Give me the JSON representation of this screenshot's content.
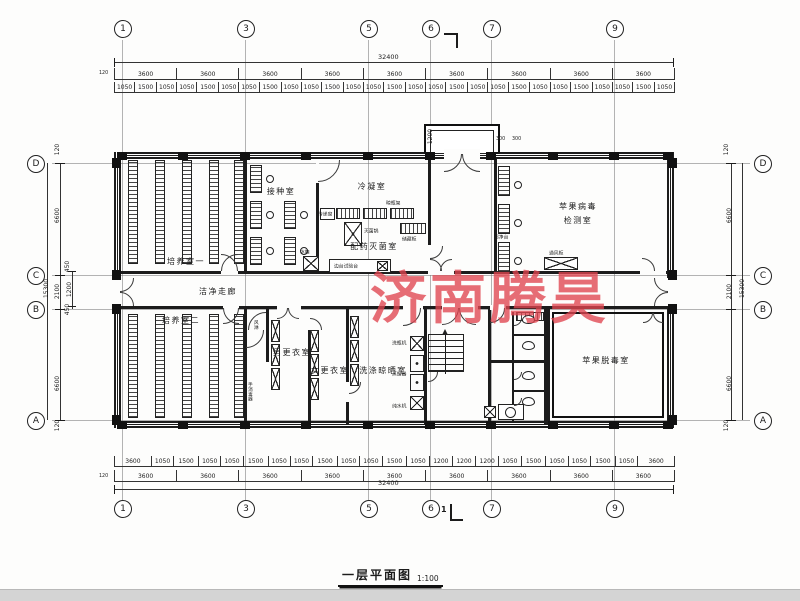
{
  "watermark": "济南腾昊",
  "title": {
    "text": "一层平面图",
    "scale": "1:100"
  },
  "section_mark": "1",
  "grid": {
    "top": [
      "1",
      "3",
      "5",
      "6",
      "7",
      "9"
    ],
    "bottom": [
      "1",
      "3",
      "5",
      "6",
      "7",
      "9"
    ],
    "left": [
      "D",
      "C",
      "B",
      "A"
    ],
    "right": [
      "D",
      "C",
      "B",
      "A"
    ]
  },
  "dims": {
    "top_overall": "32400",
    "top_offset": "120",
    "top_bays": [
      "3600",
      "3600",
      "3600",
      "3600",
      "3600",
      "3600",
      "3600",
      "3600",
      "3600"
    ],
    "top_detail": [
      "1050",
      "1500",
      "1050",
      "1050",
      "1500",
      "1050",
      "1050",
      "1500",
      "1050",
      "1050",
      "1500",
      "1050",
      "1050",
      "1500",
      "1050",
      "1050",
      "1500",
      "1050",
      "1050",
      "1500",
      "1050",
      "1050",
      "1500",
      "1050",
      "1050",
      "1500",
      "1050"
    ],
    "bottom_detail": [
      "3600",
      "1050",
      "1500",
      "1050",
      "1050",
      "1500",
      "1050",
      "1050",
      "1500",
      "1050",
      "1050",
      "1500",
      "1050",
      "1200",
      "1200",
      "1200",
      "1050",
      "1500",
      "1050",
      "1050",
      "1500",
      "1050",
      "3600"
    ],
    "bottom_bays": [
      "3600",
      "3600",
      "3600",
      "3600",
      "3600",
      "3600",
      "3600",
      "3600",
      "3600"
    ],
    "bottom_overall": "32400",
    "bottom_offset": "120",
    "left": {
      "offset_top": "120",
      "d_c": "6600",
      "sub_450a": "450",
      "sub_1200": "1200",
      "sub_450b": "450",
      "c_b": "2100",
      "overall": "15300",
      "b_a": "6600",
      "offset_bottom": "120"
    },
    "right": {
      "offset_top": "120",
      "d_c": "6600",
      "c_b": "2100",
      "overall": "15300",
      "b_a": "6600",
      "offset_bottom": "120"
    },
    "vestibule": {
      "depth": "1200",
      "w1": "300",
      "w2": "300"
    }
  },
  "rooms": {
    "culture1": "培养室一",
    "inoculation": "接种室",
    "condensation": "冷凝室",
    "sterilization": "配药灭菌室",
    "corridor": "洁净走廊",
    "culture2": "培养室二",
    "men_changing": "男更衣室",
    "women_changing": "女更衣室",
    "washing": "洗涤晾晒室",
    "virus_test_line1": "苹果病毒",
    "virus_test_line2": "检测室",
    "detox": "苹果脱毒室"
  },
  "equipment": {
    "pass_window": "传递窗",
    "sterilizer": "灭菌锅",
    "storage_cabinet": "储藏柜",
    "bottle_rack": "晾瓶架",
    "clean_bench": "超净台",
    "fume_hood": "通风柜",
    "fridge": "冰箱",
    "side_bench": "边台试验台",
    "air_shower": "风淋",
    "hand_sanitizer": "手消毒器",
    "bottle_washer": "洗瓶机",
    "distiller": "蒸馏器",
    "water_purifier": "纯水机"
  }
}
